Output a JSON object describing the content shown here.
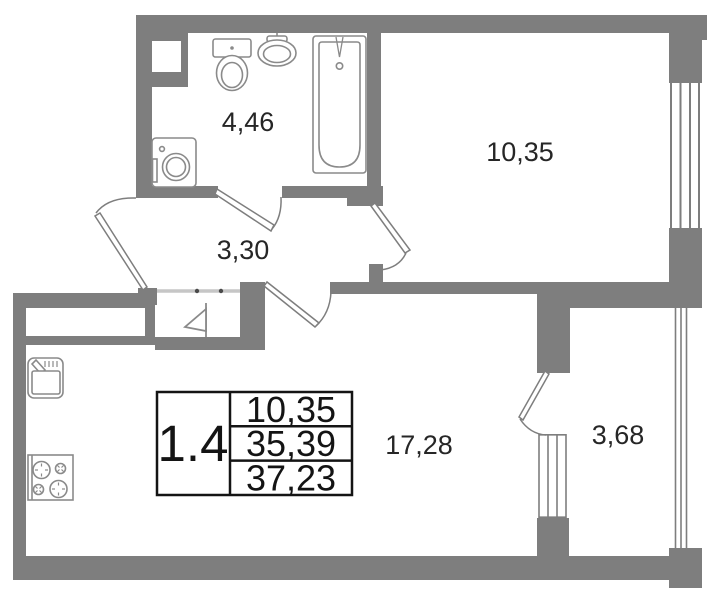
{
  "rooms": [
    {
      "name": "bathroom",
      "area": "4,46"
    },
    {
      "name": "bedroom",
      "area": "10,35"
    },
    {
      "name": "hallway",
      "area": "3,30"
    },
    {
      "name": "kitchen_living_room",
      "area": "17,28"
    },
    {
      "name": "balcony",
      "area": "3,68"
    }
  ],
  "info_table": {
    "apartment_label": "1.4",
    "values": [
      "10,35",
      "35,39",
      "37,23"
    ]
  },
  "colors": {
    "wall": "#7e7e7e",
    "fixture": "#8a8a8a",
    "text": "#262626",
    "table_border": "#141414",
    "threshold": "#c6c6c6",
    "background": "#ffffff"
  }
}
